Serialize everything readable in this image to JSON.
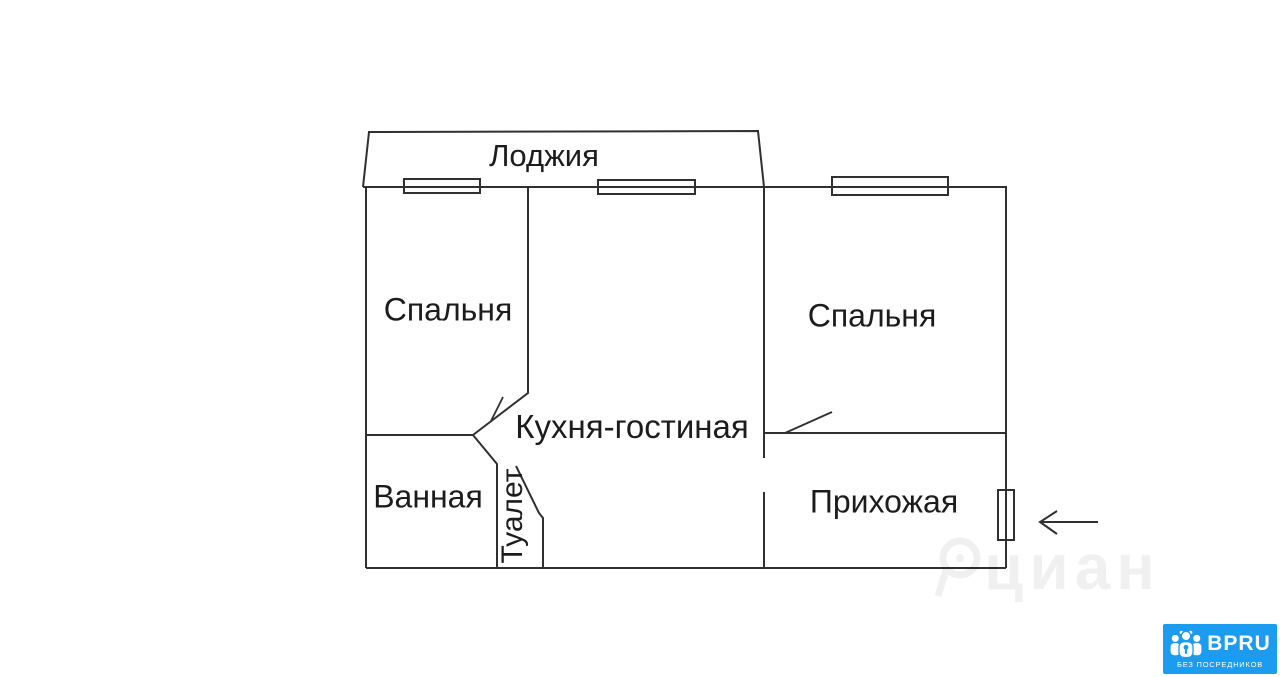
{
  "rooms": {
    "loggia": "Лоджия",
    "bedroom_left": "Спальня",
    "bedroom_right": "Спальня",
    "kitchen_living": "Кухня-гостиная",
    "bathroom": "Ванная",
    "toilet": "Туалет",
    "hallway": "Прихожая"
  },
  "watermark": {
    "text": "циан"
  },
  "badge": {
    "brand": "BPRU",
    "tagline": "БЕЗ ПОСРЕДНИКОВ",
    "background_color": "#1b9cf0",
    "text_color": "#ffffff"
  },
  "colors": {
    "wall": "#303030",
    "background": "#ffffff"
  }
}
